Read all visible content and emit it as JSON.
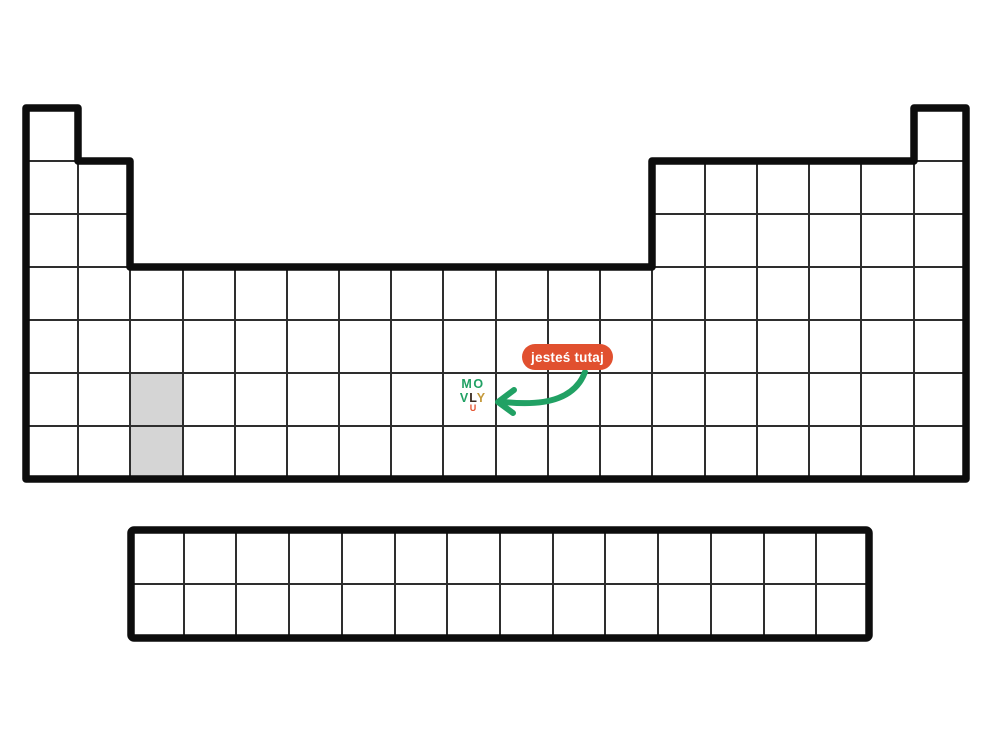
{
  "page": {
    "description": "Blank periodic table outline with you-are-here badge"
  },
  "colors": {
    "background": "#ffffff",
    "grid_line": "#2e2e2e",
    "outline": "#0d0d0d",
    "placeholder_cell": "#d5d5d5",
    "badge_bg": "#e1502f",
    "badge_text": "#ffffff",
    "arrow": "#21a164",
    "logo_green": "#21a164",
    "logo_dark": "#3a2a20",
    "logo_gold": "#c4993b",
    "logo_orange": "#e4512e"
  },
  "badge": {
    "label": "jesteś tutaj"
  },
  "logo": {
    "m": "M",
    "o": "O",
    "v": "V",
    "l": "L",
    "y": "Y",
    "smile": "U"
  },
  "table": {
    "main_columns": 18,
    "main_rows": 7,
    "row1_cells": [
      "column 1",
      "column 18"
    ],
    "rows2_3_cells": [
      "columns 1-2",
      "columns 13-18"
    ],
    "rows4_7_cells": "columns 1-18",
    "f_block_columns": 14,
    "f_block_rows": 2,
    "highlighted_cells": [
      {
        "column": 3,
        "row": 6,
        "color": "#d5d5d5"
      },
      {
        "column": 3,
        "row": 7,
        "color": "#d5d5d5"
      }
    ],
    "you_are_here_cell": {
      "column": 9,
      "row": 6
    }
  }
}
